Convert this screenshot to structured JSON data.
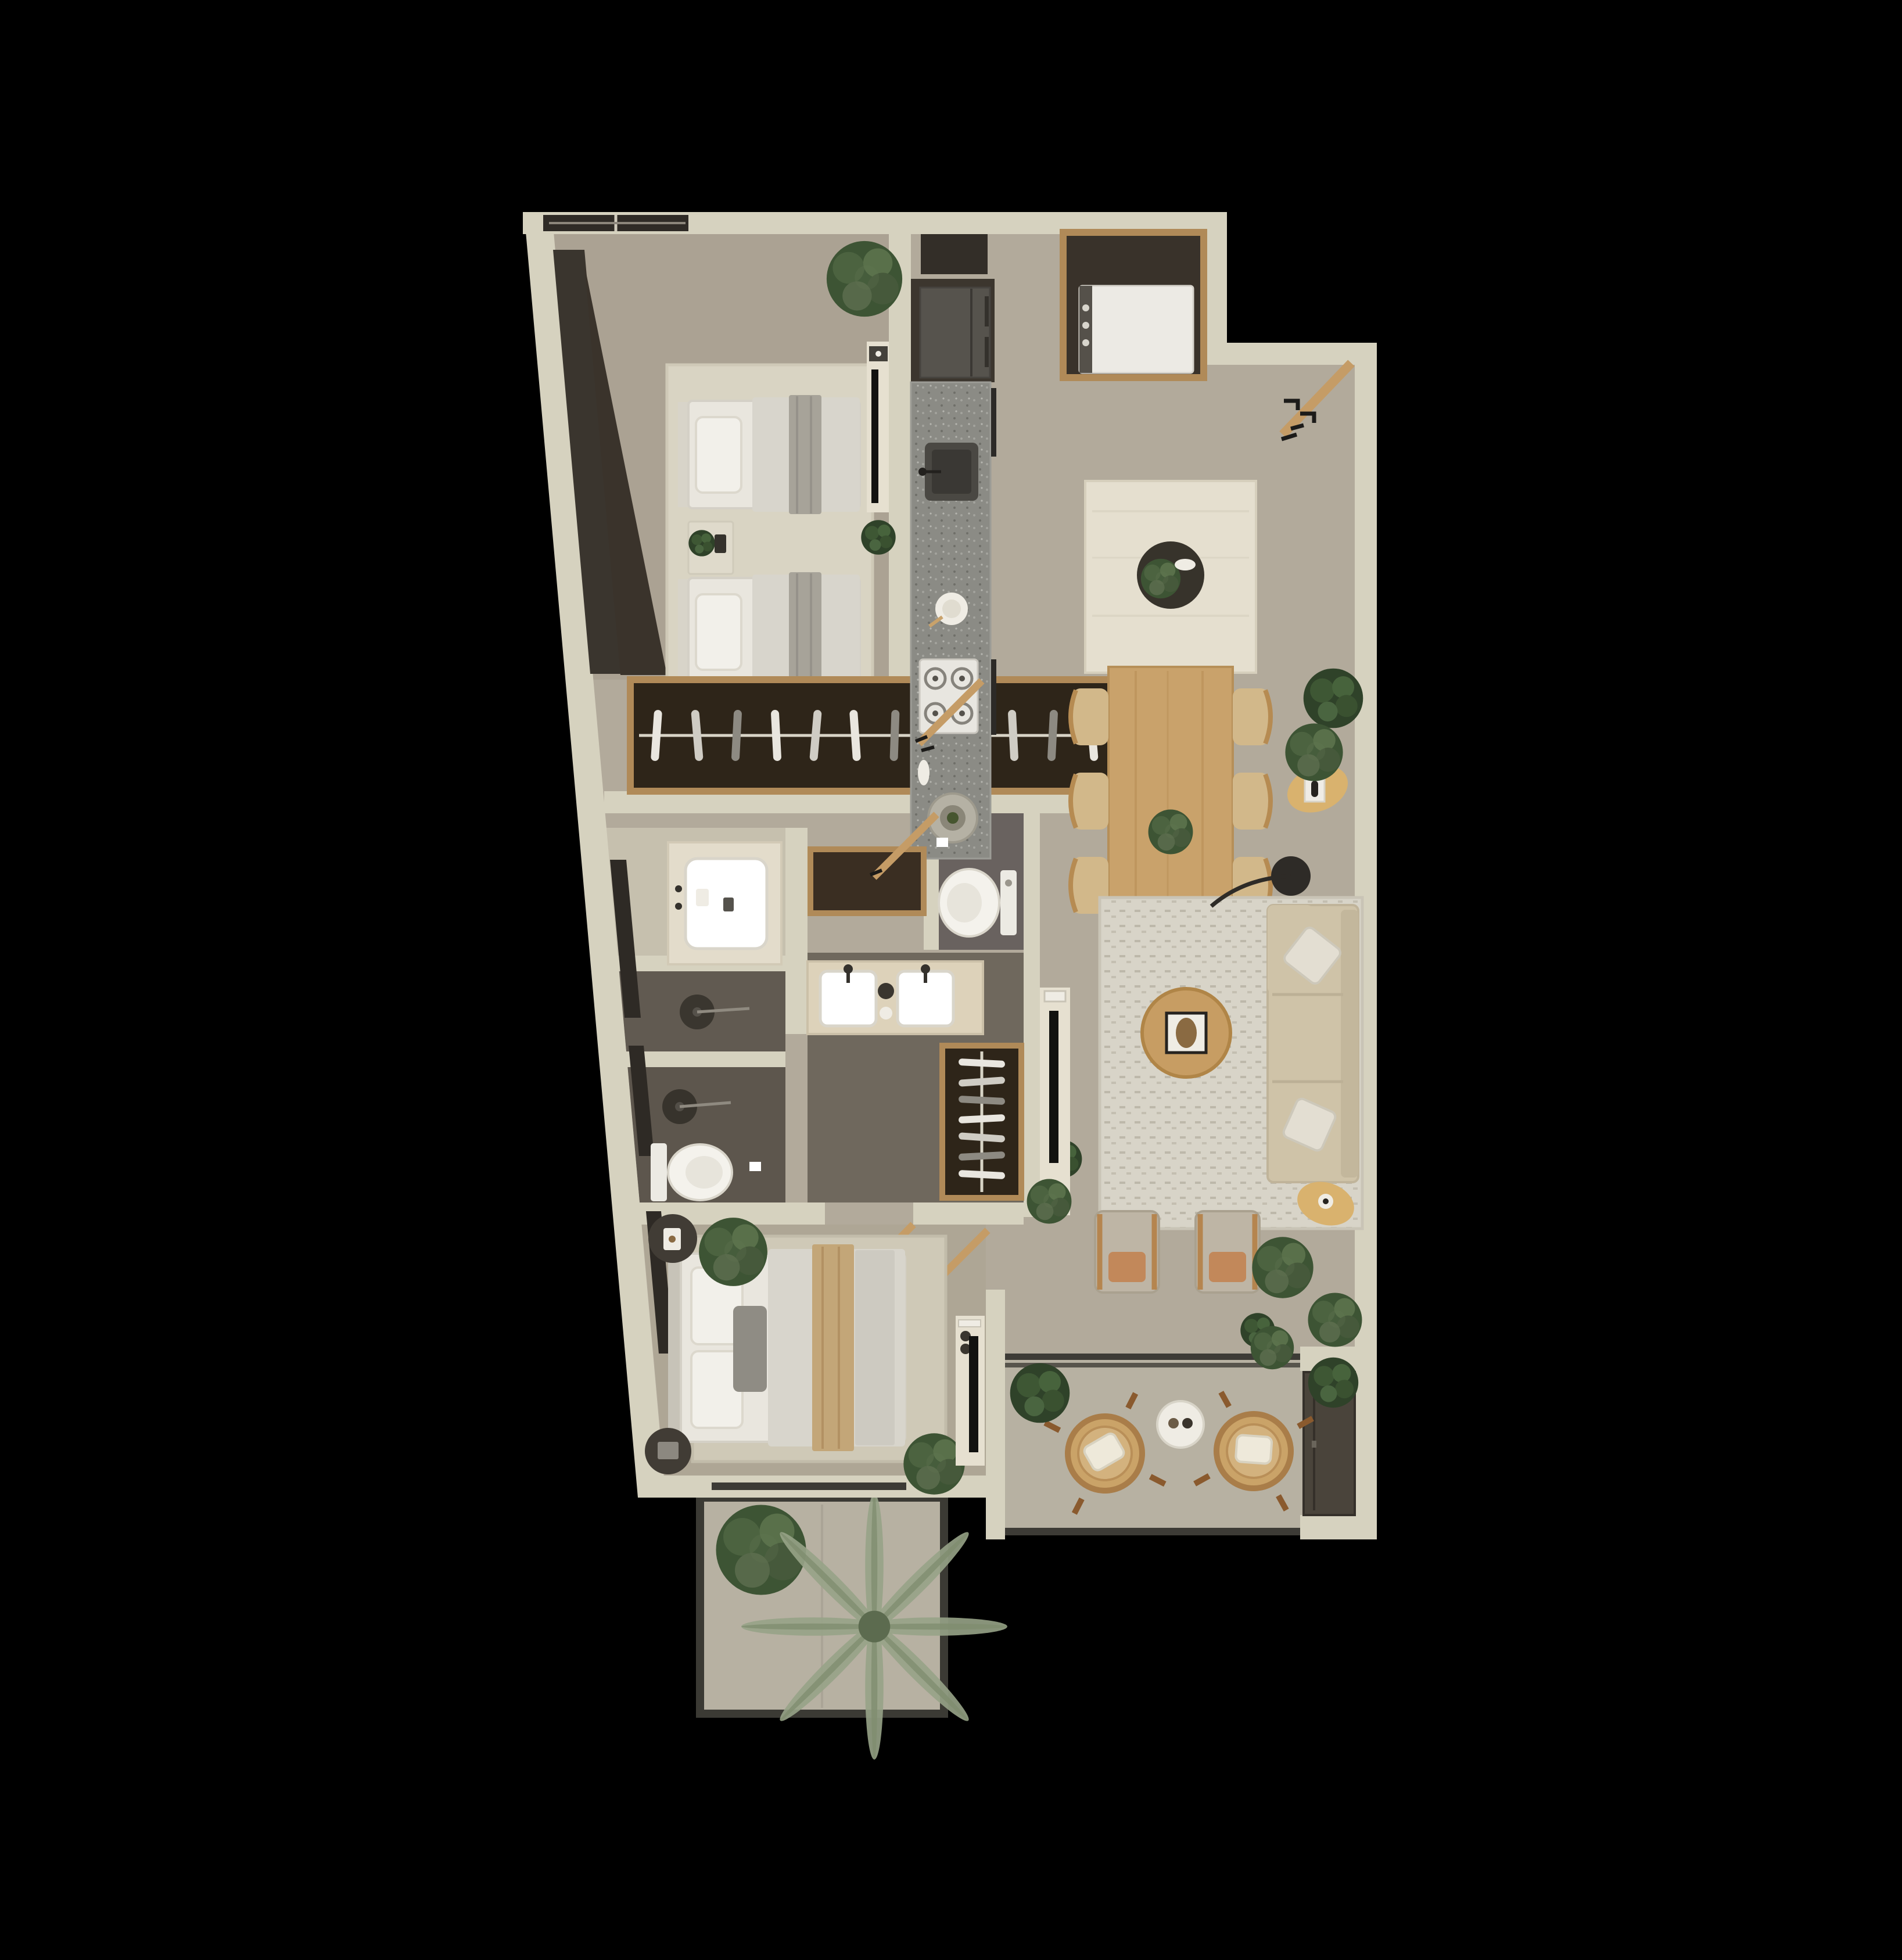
{
  "meta": {
    "title": "Apartment floor plan – rendered top view",
    "type": "architectural-render",
    "background": "#000000"
  },
  "colors": {
    "bg": "#000000",
    "wall": "#d6d2bf",
    "floor": "#b2aa9b",
    "floor-bed": "#aba293",
    "floor-master": "#aea695",
    "floor-out": "#b7b1a2",
    "floor-light": "#c6c0ae",
    "tile-dark": "#615a51",
    "tile-dark2": "#5d564d",
    "tile-wc": "#69625f",
    "tile-bath": "#6f685d",
    "rug": "#d9d4c3",
    "rug-liv": "#d8d4c8",
    "rug-master": "#cfc9b7",
    "wood": "#c59c66",
    "wood-dining": "#c9a26b",
    "wood-dark": "#3a2e22",
    "wood-trim": "#b08a58",
    "white": "#efece4",
    "linen": "#e9e6de",
    "duvet": "#d8d5cc",
    "grey-throw": "#a7a399",
    "sofa": "#cfc3a8",
    "tan": "#c2885a",
    "rattan": "#caa368",
    "rattan-rim": "#a97d49",
    "counter": "#8b8b85",
    "island": "#e5dfcf",
    "appliance": "#56534d",
    "niche": "#3c362e",
    "glass": "#3a352e",
    "rail": "#3d3b36",
    "louver": "#4a443b",
    "plant": "#3d5434",
    "plant2": "#59704a",
    "palm": "#97a387"
  },
  "rooms": [
    {
      "id": "twin-bedroom",
      "label": "Twin bedroom",
      "items": [
        "single bed x2",
        "nightstand with plant",
        "area rug",
        "tv console with tv",
        "wardrobe with hanging clothes",
        "corner plant",
        "window band"
      ]
    },
    {
      "id": "bathroom-1",
      "label": "Bathroom 1",
      "items": [
        "vanity with sink",
        "walk-in shower",
        "shower head"
      ]
    },
    {
      "id": "guest-wc",
      "label": "Guest WC",
      "items": [
        "toilet",
        "toilet paper holder"
      ]
    },
    {
      "id": "master-bathroom",
      "label": "Master bathroom",
      "items": [
        "double vanity",
        "walk-in shower",
        "wc with toilet",
        "bench console",
        "clothes rack"
      ]
    },
    {
      "id": "master-bedroom",
      "label": "Master bedroom",
      "items": [
        "double bed",
        "round nightstand x2",
        "area rug",
        "tv console with tv",
        "plants",
        "sliding door to patio"
      ]
    },
    {
      "id": "kitchen",
      "label": "Kitchen",
      "items": [
        "counter run",
        "square sink",
        "gas cooktop",
        "serving plate",
        "round board",
        "fridge",
        "upper cabinet niche"
      ]
    },
    {
      "id": "laundry",
      "label": "Laundry closet",
      "items": [
        "washer in wood-framed niche"
      ]
    },
    {
      "id": "entry",
      "label": "Entry",
      "items": [
        "open entry door",
        "wall hooks"
      ]
    },
    {
      "id": "living-dining",
      "label": "Living / dining",
      "items": [
        "kitchen island with tray plant",
        "dining table for six",
        "dining chairs x6",
        "sofa",
        "arc floor lamp",
        "coffee table with tray",
        "armchair x2",
        "side table x2",
        "textured rug",
        "media wall with tv",
        "plants"
      ]
    },
    {
      "id": "balcony",
      "label": "Balcony",
      "items": [
        "rattan lounge chair x2",
        "round side table with cups",
        "planters",
        "louvered equipment screen",
        "sliding door"
      ]
    },
    {
      "id": "patio",
      "label": "Patio",
      "items": [
        "fiddle leaf plant",
        "palm plant",
        "railing"
      ]
    }
  ]
}
